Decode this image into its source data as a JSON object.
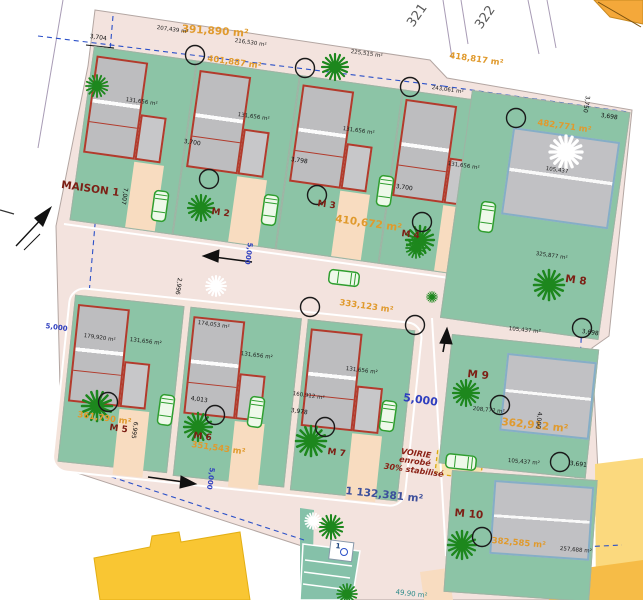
{
  "site": {
    "parcel_numbers": [
      "321",
      "322"
    ],
    "total_plots": 10
  },
  "plots": {
    "m1": {
      "name": "MAISON 1",
      "area": "391,890 m²",
      "house_area": "131,656 m²",
      "front_area": "207,439 m²"
    },
    "m2": {
      "name": "M 2",
      "area": "401,887 m²",
      "house_area": "131,656 m²",
      "front_area": "216,530 m²"
    },
    "m3": {
      "name": "M 3",
      "area": "410,672 m²",
      "house_area": "131,656 m²",
      "front_area": "225,515 m²"
    },
    "m4": {
      "name": "M 4",
      "area": "418,817 m²",
      "house_area": "131,656 m²",
      "front_area": "243,061 m²"
    },
    "m5": {
      "name": "M 5",
      "area": "361,790 m²",
      "house_area": "131,656 m²",
      "front_area": "179,920 m²"
    },
    "m6": {
      "name": "M 6",
      "area": "351,543 m²",
      "house_area": "131,656 m²",
      "front_area": "174,053 m²"
    },
    "m7": {
      "name": "M 7",
      "area": "333,123 m²",
      "house_area": "131,656 m²",
      "front_area": "160,912 m²"
    },
    "m8": {
      "name": "M 8",
      "area": "482,771 m²",
      "house_area": "105,437",
      "front_area": "325,877 m²"
    },
    "m9": {
      "name": "M 9",
      "area": "362,912 m²",
      "house_area": "105,437 m²",
      "front_area": "208,772 m²"
    },
    "m10": {
      "name": "M 10",
      "area": "382,585 m²",
      "house_area": "105,437 m²",
      "front_area": "257,688 m²"
    }
  },
  "road": {
    "label_lines": [
      "VOIRIE",
      "enrobé",
      "30% stabilisé"
    ],
    "total_area": "1 132,381 m²",
    "width_dim": "5,000"
  },
  "dims": [
    "3,704",
    "3,700",
    "3,798",
    "3,700",
    "3,750",
    "3,698",
    "3,698",
    "4,013",
    "3,978",
    "4,000",
    "3,691",
    "2,996",
    "6,995",
    "7,007"
  ],
  "parking": {
    "stall_number": "1"
  },
  "misc": {
    "annex_area": "49,90 m²"
  },
  "colors": {
    "plot_green": "#8cc4a6",
    "road_pink": "#f3e3de",
    "driveway_peach": "#f8dcc0",
    "house_gray": "#bdbdbf",
    "house_outline_red": "#b23b2c",
    "big_house_outline": "#85aec7",
    "area_orange": "#e09a2d",
    "name_red": "#7c1f15",
    "dim_blue": "#2f3fbf",
    "parking_teal": "#85c1a9",
    "existing_yellow": "#f9c633",
    "existing_orange": "#f4a83a"
  }
}
